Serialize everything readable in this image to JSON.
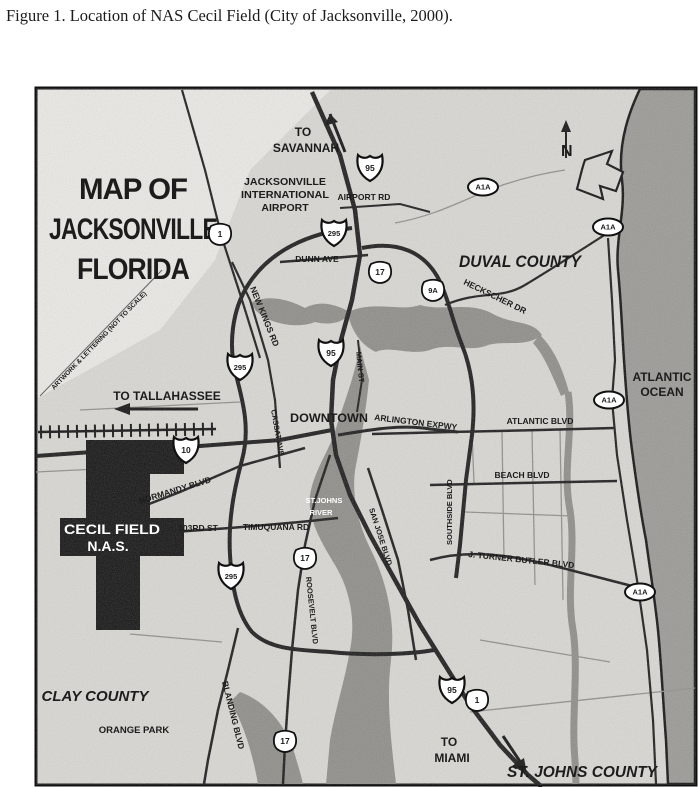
{
  "figure_caption": "Figure 1. Location of NAS Cecil Field (City of Jacksonville, 2000).",
  "map": {
    "title_line1": "MAP OF",
    "title_line2": "JACKSONVILLE",
    "title_line3": "FLORIDA",
    "compass_label": "N",
    "note": "ARTWORK & LETTERING (NOT TO SCALE)",
    "counties": {
      "duval": "DUVAL COUNTY",
      "clay": "CLAY COUNTY",
      "st_johns": "ST. JOHNS COUNTY"
    },
    "water": {
      "ocean_line1": "ATLANTIC",
      "ocean_line2": "OCEAN",
      "river_line1": "ST.JOHNS",
      "river_line2": "RIVER"
    },
    "destinations": {
      "savannah_line1": "TO",
      "savannah_line2": "SAVANNAH",
      "tallahassee": "TO TALLAHASSEE",
      "miami_line1": "TO",
      "miami_line2": "MIAMI"
    },
    "places": {
      "airport_line1": "JACKSONVILLE",
      "airport_line2": "INTERNATIONAL",
      "airport_line3": "AIRPORT",
      "downtown": "DOWNTOWN",
      "orange_park": "ORANGE PARK",
      "cecil_line1": "CECIL FIELD",
      "cecil_line2": "N.A.S."
    },
    "roads": {
      "airport_rd": "AIRPORT RD",
      "dunn_ave": "DUNN AVE",
      "new_kings_rd": "NEW KINGS RD",
      "heckscher_dr": "HECKSCHER DR",
      "main_st": "MAIN ST",
      "arlington_expwy": "ARLINGTON EXPWY",
      "atlantic_blvd": "ATLANTIC BLVD",
      "beach_blvd": "BEACH BLVD",
      "southside_blvd": "SOUTHSIDE BLVD",
      "jtb_blvd": "J. TURNER BUTLER BLVD",
      "normandy_blvd": "NORMANDY BLVD",
      "rd_103": "103RD ST",
      "timuquana_rd": "TIMUQUANA RD",
      "san_jose_blvd": "SAN JOSE BLVD",
      "cassat_ave": "CASSAT AVE",
      "roosevelt_blvd": "ROOSEVELT BLVD",
      "blanding_blvd": "BLANDING BLVD"
    },
    "shields": [
      {
        "system": "interstate",
        "number": "95"
      },
      {
        "system": "interstate",
        "number": "295"
      },
      {
        "system": "interstate",
        "number": "95"
      },
      {
        "system": "interstate",
        "number": "295"
      },
      {
        "system": "interstate",
        "number": "10"
      },
      {
        "system": "interstate",
        "number": "295"
      },
      {
        "system": "interstate",
        "number": "95"
      },
      {
        "system": "us",
        "number": "1"
      },
      {
        "system": "us",
        "number": "17"
      },
      {
        "system": "us",
        "number": "9A"
      },
      {
        "system": "us",
        "number": "17"
      },
      {
        "system": "us",
        "number": "17"
      },
      {
        "system": "us",
        "number": "1"
      },
      {
        "system": "state",
        "number": "A1A"
      },
      {
        "system": "state",
        "number": "A1A"
      },
      {
        "system": "state",
        "number": "A1A"
      },
      {
        "system": "state",
        "number": "A1A"
      }
    ],
    "colors": {
      "land": "#d9d8d3",
      "ocean": "#9a9995",
      "river": "#8e8d88",
      "road": "#1a1a1a",
      "nas_fill": "#121212"
    }
  }
}
